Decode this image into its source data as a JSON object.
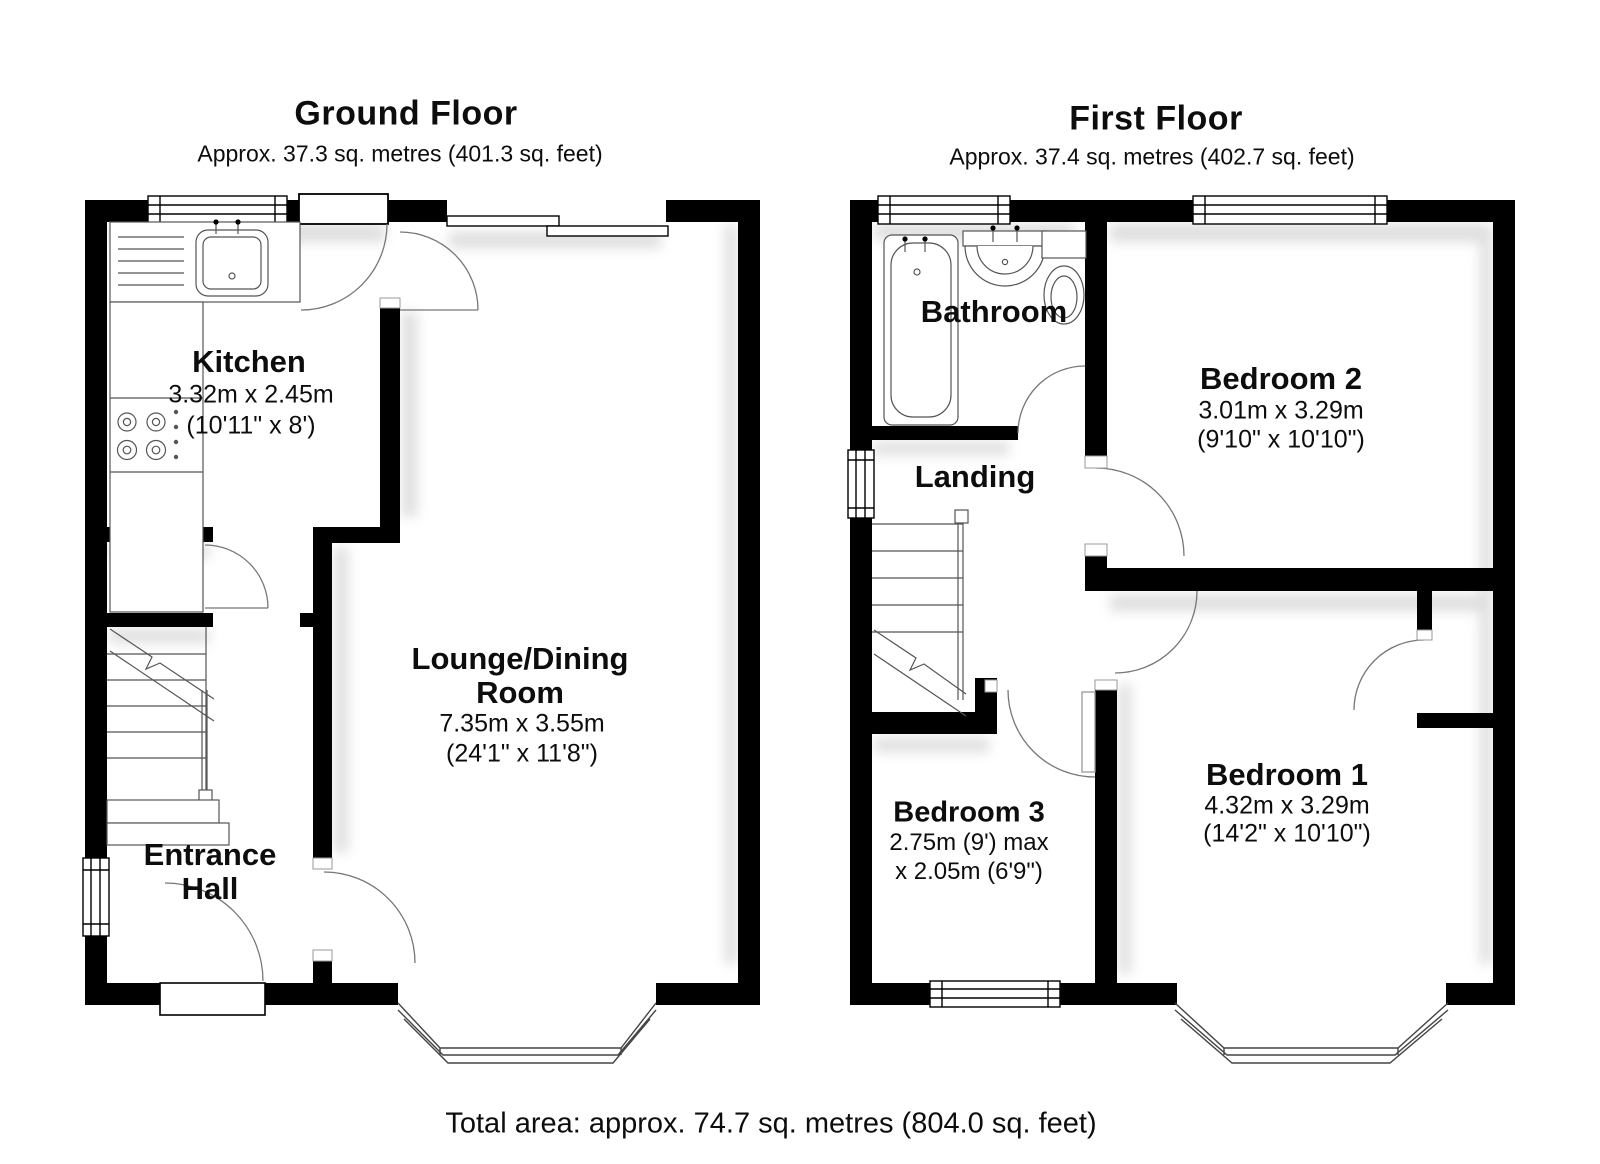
{
  "page": {
    "background": "#ffffff",
    "wall_color": "#000000"
  },
  "ground_floor": {
    "title": "Ground Floor",
    "subtitle": "Approx. 37.3 sq. metres (401.3 sq. feet)",
    "rooms": {
      "kitchen": {
        "name": "Kitchen",
        "dim_metric": "3.32m x 2.45m",
        "dim_imperial": "(10'11\" x 8')"
      },
      "lounge_dining": {
        "name_line1": "Lounge/Dining",
        "name_line2": "Room",
        "dim_metric": "7.35m x 3.55m",
        "dim_imperial": "(24'1\" x 11'8\")"
      },
      "entrance_hall": {
        "name_line1": "Entrance",
        "name_line2": "Hall"
      }
    }
  },
  "first_floor": {
    "title": "First Floor",
    "subtitle": "Approx. 37.4 sq. metres (402.7 sq. feet)",
    "rooms": {
      "bathroom": {
        "name": "Bathroom"
      },
      "landing": {
        "name": "Landing"
      },
      "bedroom2": {
        "name": "Bedroom 2",
        "dim_metric": "3.01m x 3.29m",
        "dim_imperial": "(9'10\" x 10'10\")"
      },
      "bedroom3": {
        "name": "Bedroom 3",
        "dim_line1": "2.75m (9') max",
        "dim_line2": "x 2.05m (6'9\")"
      },
      "bedroom1": {
        "name": "Bedroom 1",
        "dim_metric": "4.32m x 3.29m",
        "dim_imperial": "(14'2\" x 10'10\")"
      }
    }
  },
  "footer": {
    "total_area": "Total area: approx. 74.7 sq. metres (804.0 sq. feet)"
  }
}
